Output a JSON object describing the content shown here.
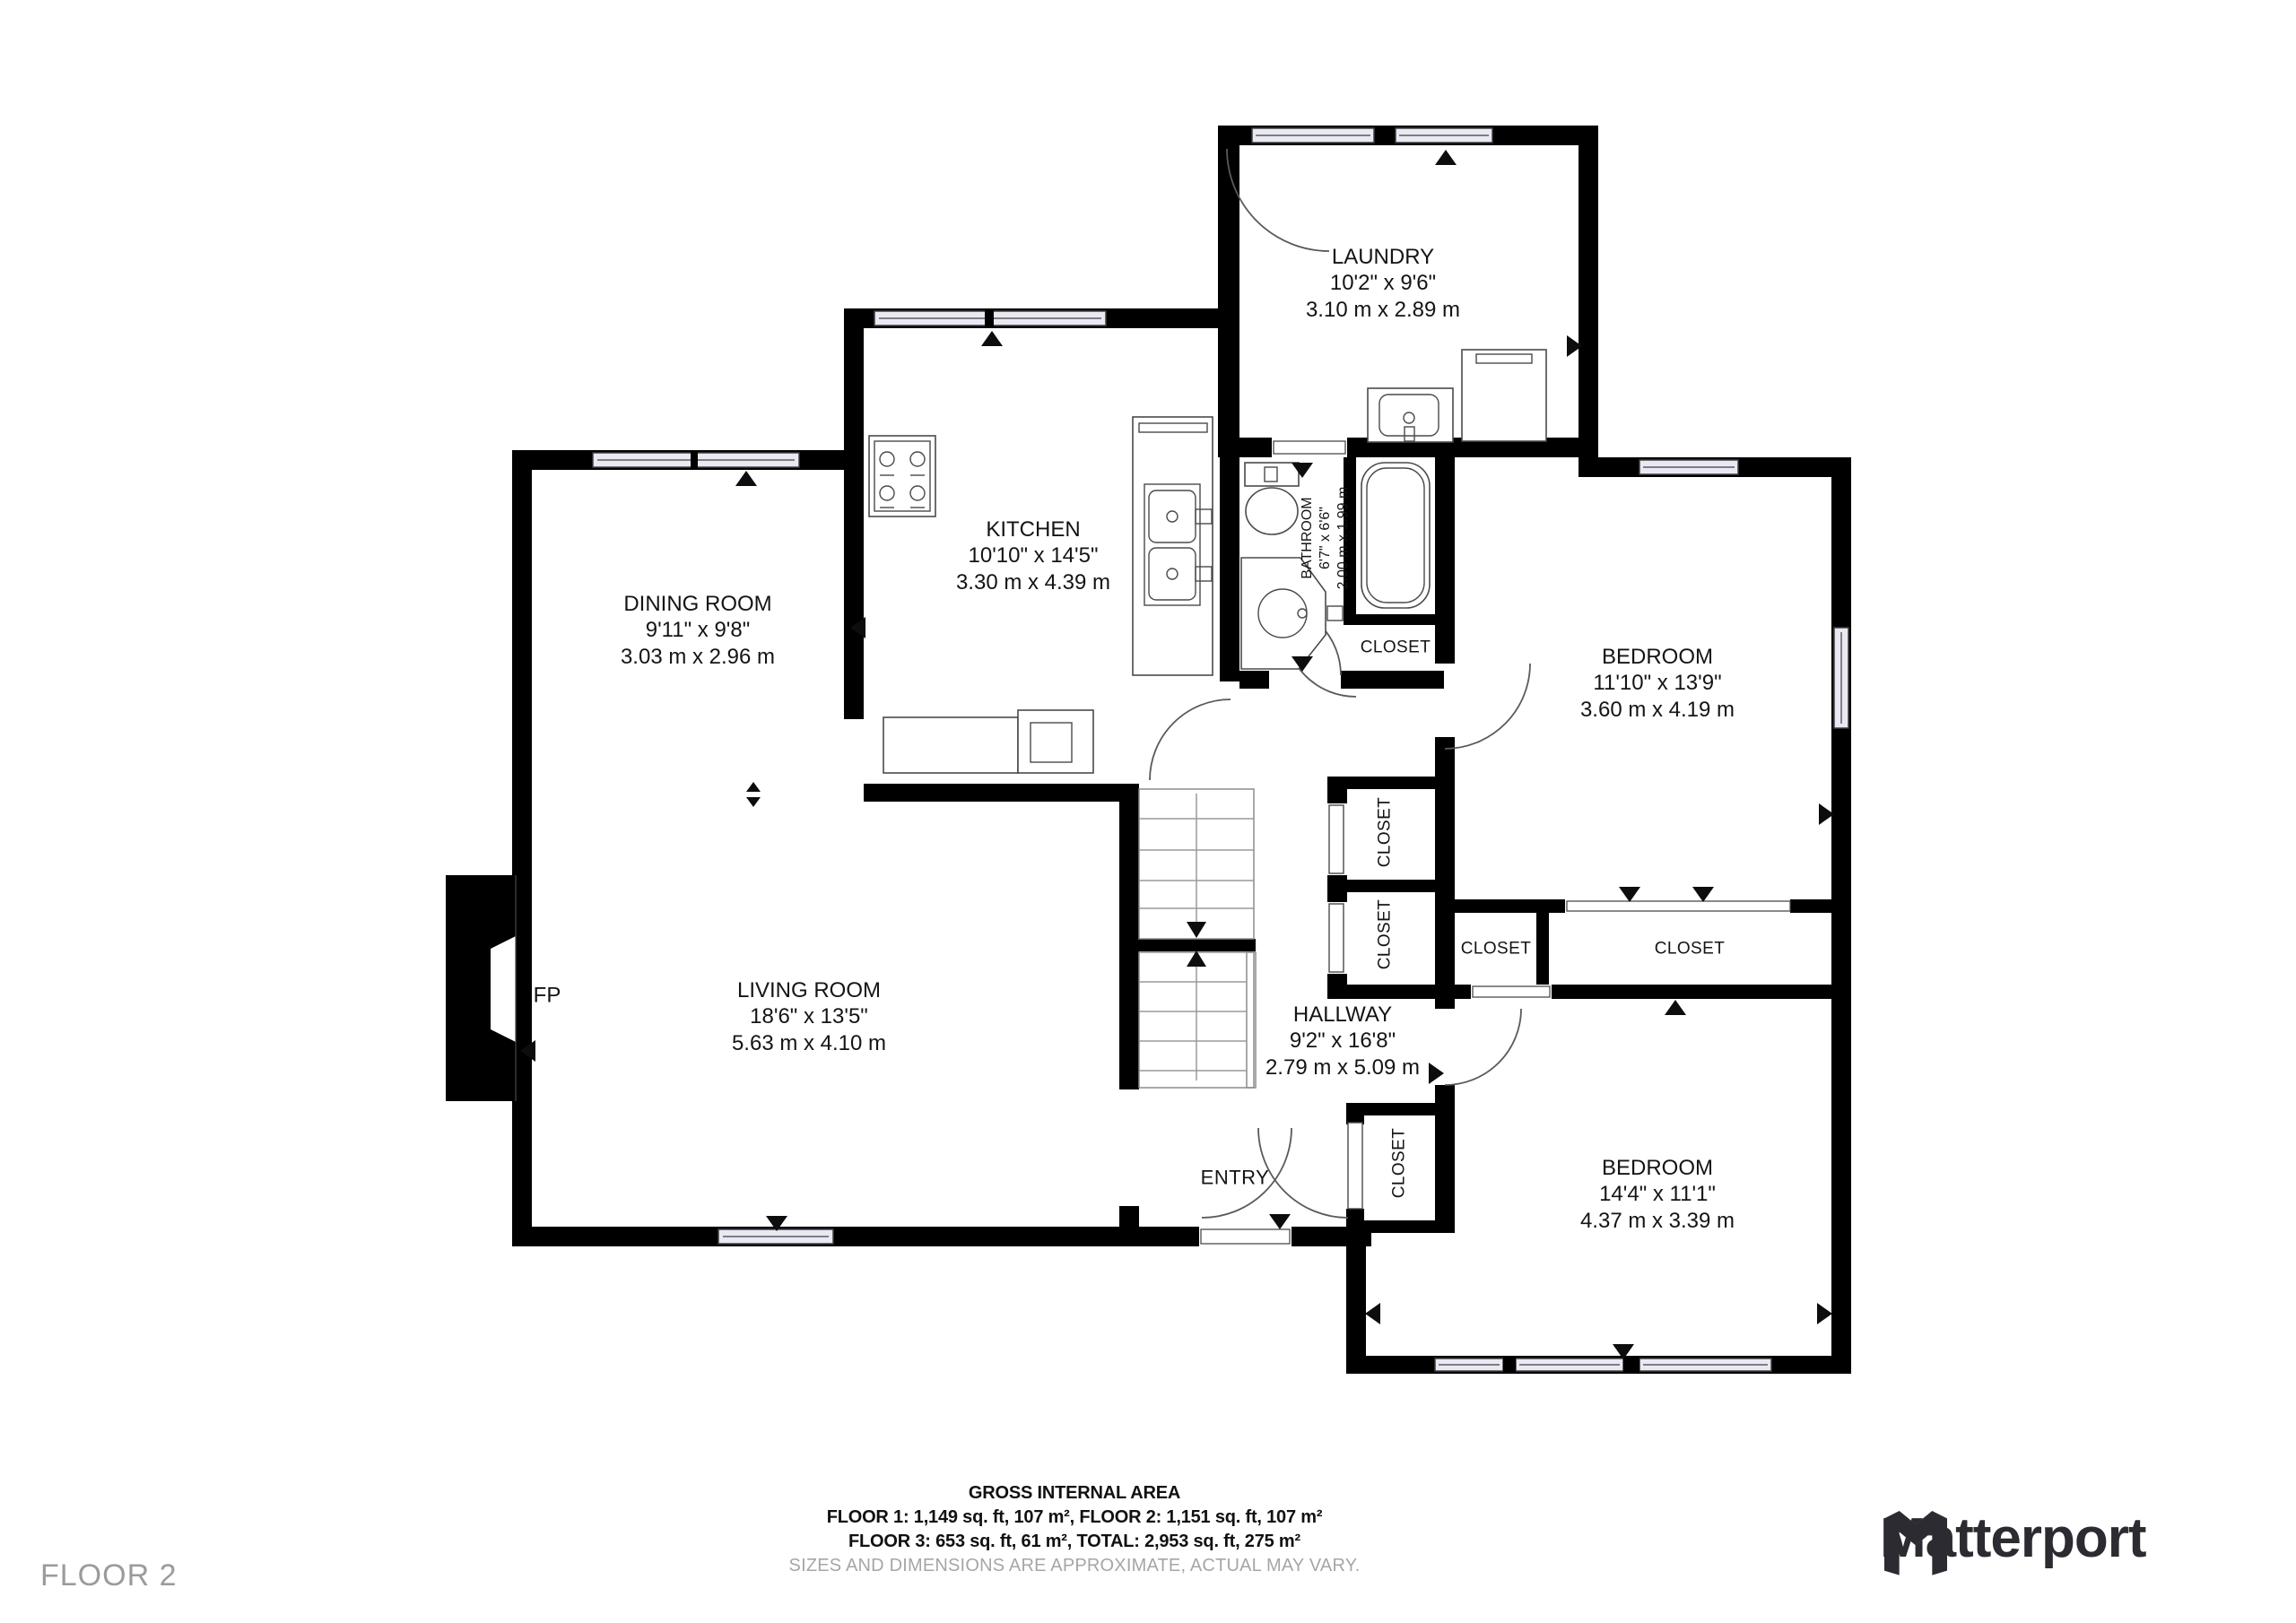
{
  "floor_label": "FLOOR 2",
  "brand": {
    "name": "Matterport"
  },
  "rooms": {
    "laundry": {
      "name": "LAUNDRY",
      "imperial": "10'2\" x 9'6\"",
      "metric": "3.10 m x 2.89 m"
    },
    "kitchen": {
      "name": "KITCHEN",
      "imperial": "10'10\" x 14'5\"",
      "metric": "3.30 m x 4.39 m"
    },
    "dining": {
      "name": "DINING ROOM",
      "imperial": "9'11\" x 9'8\"",
      "metric": "3.03 m x 2.96 m"
    },
    "living": {
      "name": "LIVING ROOM",
      "imperial": "18'6\" x 13'5\"",
      "metric": "5.63 m x 4.10 m"
    },
    "bathroom": {
      "name": "BATHROOM",
      "imperial": "6'7\" x 6'6\"",
      "metric": "2.00 m x 1.99 m"
    },
    "bedroom_upper": {
      "name": "BEDROOM",
      "imperial": "11'10\" x 13'9\"",
      "metric": "3.60 m x 4.19 m"
    },
    "bedroom_lower": {
      "name": "BEDROOM",
      "imperial": "14'4\" x 11'1\"",
      "metric": "4.37 m x 3.39 m"
    },
    "hallway": {
      "name": "HALLWAY",
      "imperial": "9'2\" x 16'8\"",
      "metric": "2.79 m x 5.09 m"
    },
    "entry": {
      "name": "ENTRY"
    },
    "fireplace": {
      "name": "FP"
    },
    "closet": "CLOSET"
  },
  "footer": {
    "title": "GROSS INTERNAL AREA",
    "line1": "FLOOR 1: 1,149 sq. ft, 107 m², FLOOR 2: 1,151 sq. ft, 107 m²",
    "line2": "FLOOR 3: 653 sq. ft, 61 m², TOTAL: 2,953 sq. ft, 275 m²",
    "disclaimer": "SIZES AND DIMENSIONS ARE APPROXIMATE, ACTUAL MAY VARY."
  },
  "colors": {
    "wall": "#000000",
    "window_fill": "#e9e9f4",
    "line": "#4a4a4a",
    "text": "#141414",
    "muted": "#a6a6a6",
    "brand_dark": "#2b2b31",
    "brand_gray": "#8f8f94"
  }
}
